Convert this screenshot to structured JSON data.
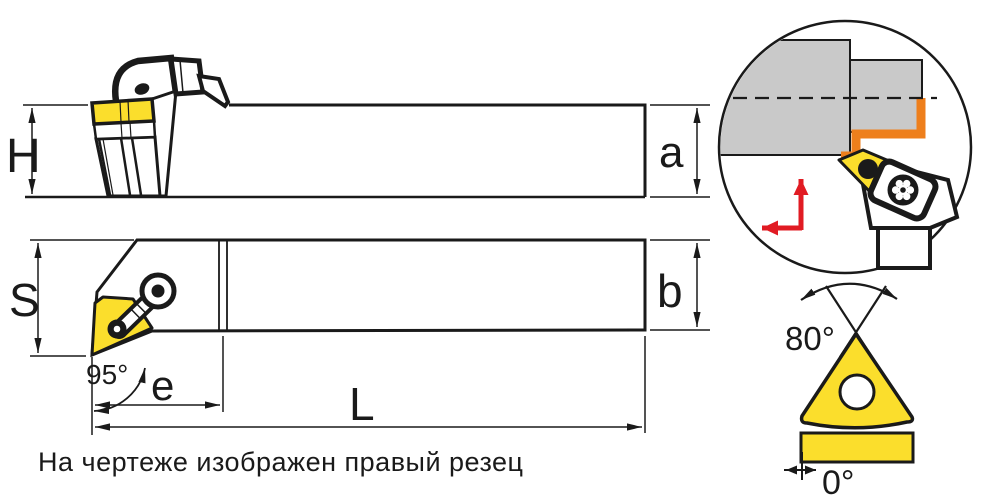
{
  "note": {
    "text": "На чертеже изображен правый резец"
  },
  "labels": {
    "overall_height": "H",
    "shank_height": "a",
    "head_width": "S",
    "shank_width": "b",
    "nose_offset": "e",
    "overall_length": "L",
    "entering_angle": "95°",
    "insert_point_angle": "80°",
    "clearance_angle": "0°"
  },
  "colors": {
    "insert-yellow": "#fbde2c",
    "profile-orange": "#ee7f1c",
    "workpiece-gray": "#c9c9c9",
    "arrow-red": "#e11b23",
    "line-black": "#1a1a1a"
  }
}
